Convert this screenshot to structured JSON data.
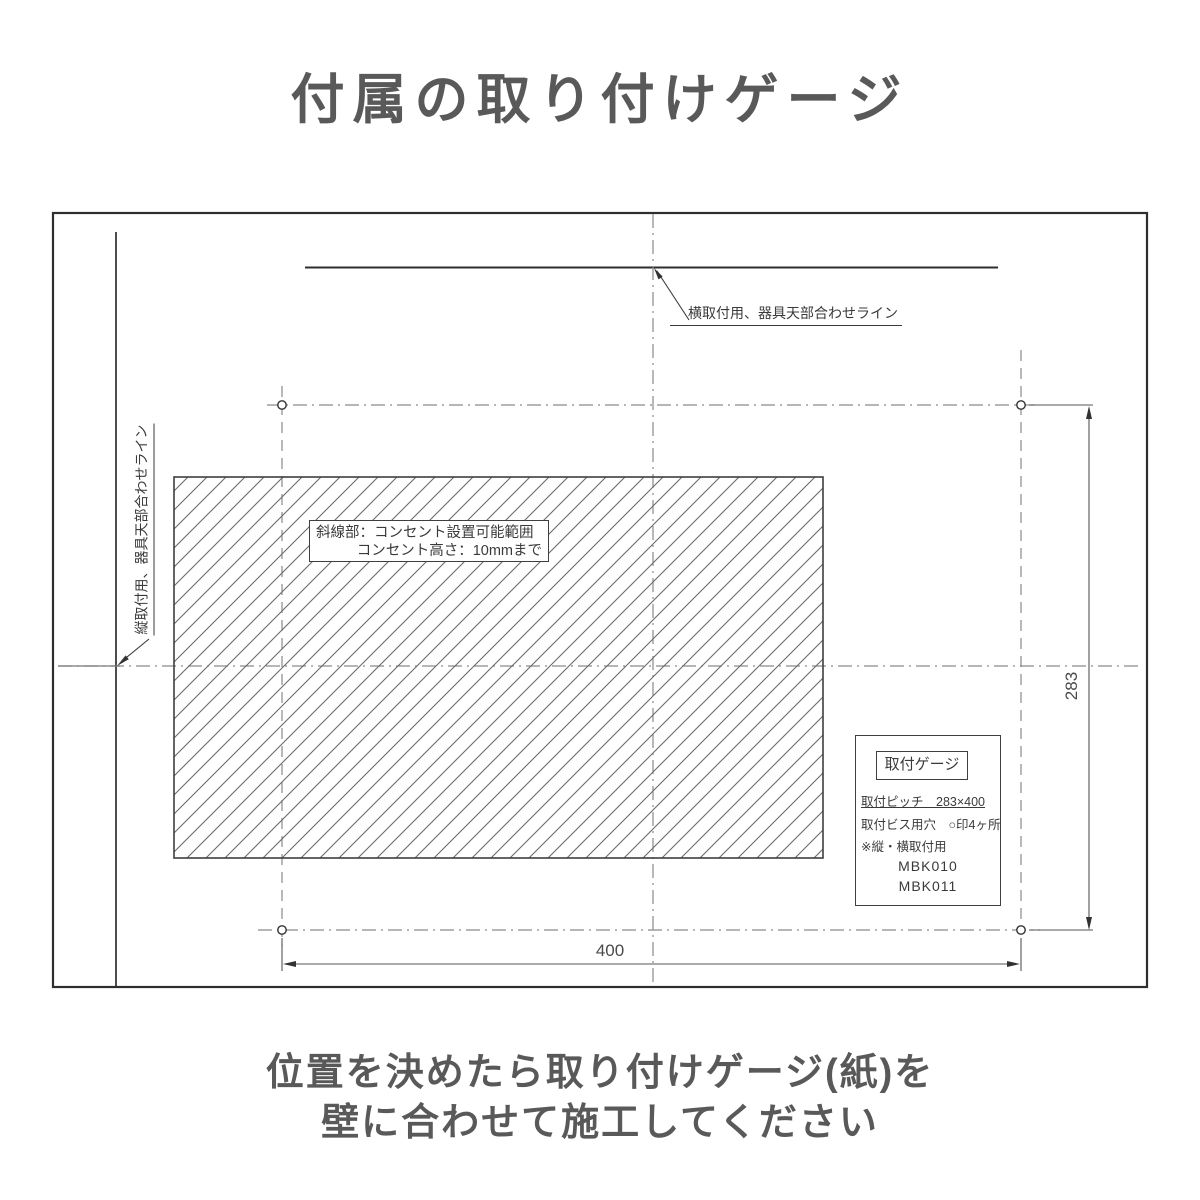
{
  "title": "付属の取り付けゲージ",
  "drawing": {
    "top_line_label": "横取付用、器具天部合わせライン",
    "left_line_label": "縦取付用、器具天部合わせライン",
    "hatch_note": {
      "line1": "斜線部：コンセント設置可能範囲",
      "line2": "コンセント高さ：10mmまで"
    },
    "info_box": {
      "title": "取付ゲージ",
      "pitch_label": "取付ピッチ　283×400",
      "screw_label": "取付ビス用穴　○印4ヶ所",
      "note": "※縦・横取付用",
      "model1": "MBK010",
      "model2": "MBK011"
    },
    "dimensions": {
      "width": "400",
      "height": "283"
    },
    "screw_hole_count": 4
  },
  "caption": {
    "line1": "位置を決めたら取り付けゲージ(紙)を",
    "line2": "壁に合わせて施工してください"
  },
  "colors": {
    "solid_line": "#2e2e2e",
    "centerline": "#8a8a8a",
    "hatch_line": "#6a6a6a",
    "heading_text": "#595959",
    "label_text": "#3a3a3a"
  }
}
